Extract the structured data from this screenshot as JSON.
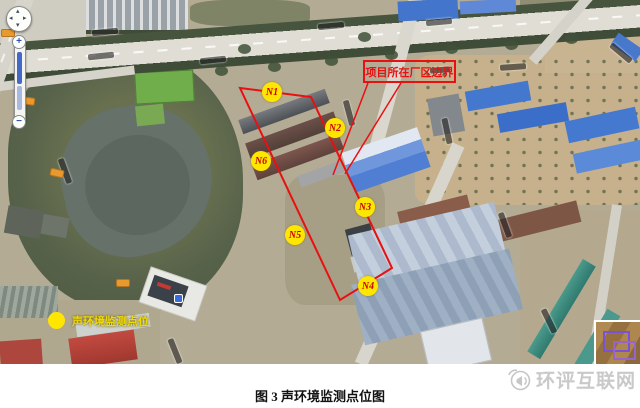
{
  "figure": {
    "caption": "图 3  声环境监测点位图",
    "watermark_text": "环评互联网"
  },
  "map": {
    "boundary_label": "项目所在厂区边界",
    "legend_label": "声环境监测点位",
    "monitoring_points": [
      {
        "id": "N1",
        "x": 272,
        "y": 92
      },
      {
        "id": "N2",
        "x": 335,
        "y": 128
      },
      {
        "id": "N3",
        "x": 365,
        "y": 207
      },
      {
        "id": "N4",
        "x": 368,
        "y": 286
      },
      {
        "id": "N5",
        "x": 295,
        "y": 235
      },
      {
        "id": "N6",
        "x": 261,
        "y": 161
      }
    ],
    "boundary_polygon": "240,88 311,97 392,268 340,300",
    "leader_lines": [
      {
        "x1": 368,
        "y1": 83,
        "x2": 333,
        "y2": 175
      },
      {
        "x1": 401,
        "y1": 83,
        "x2": 345,
        "y2": 174
      }
    ],
    "colors": {
      "boundary_red": "#e81010",
      "point_yellow": "#ffe600",
      "point_text_red": "#cc0000"
    }
  },
  "controls": {
    "zoom_in_label": "+",
    "zoom_out_label": "−"
  }
}
